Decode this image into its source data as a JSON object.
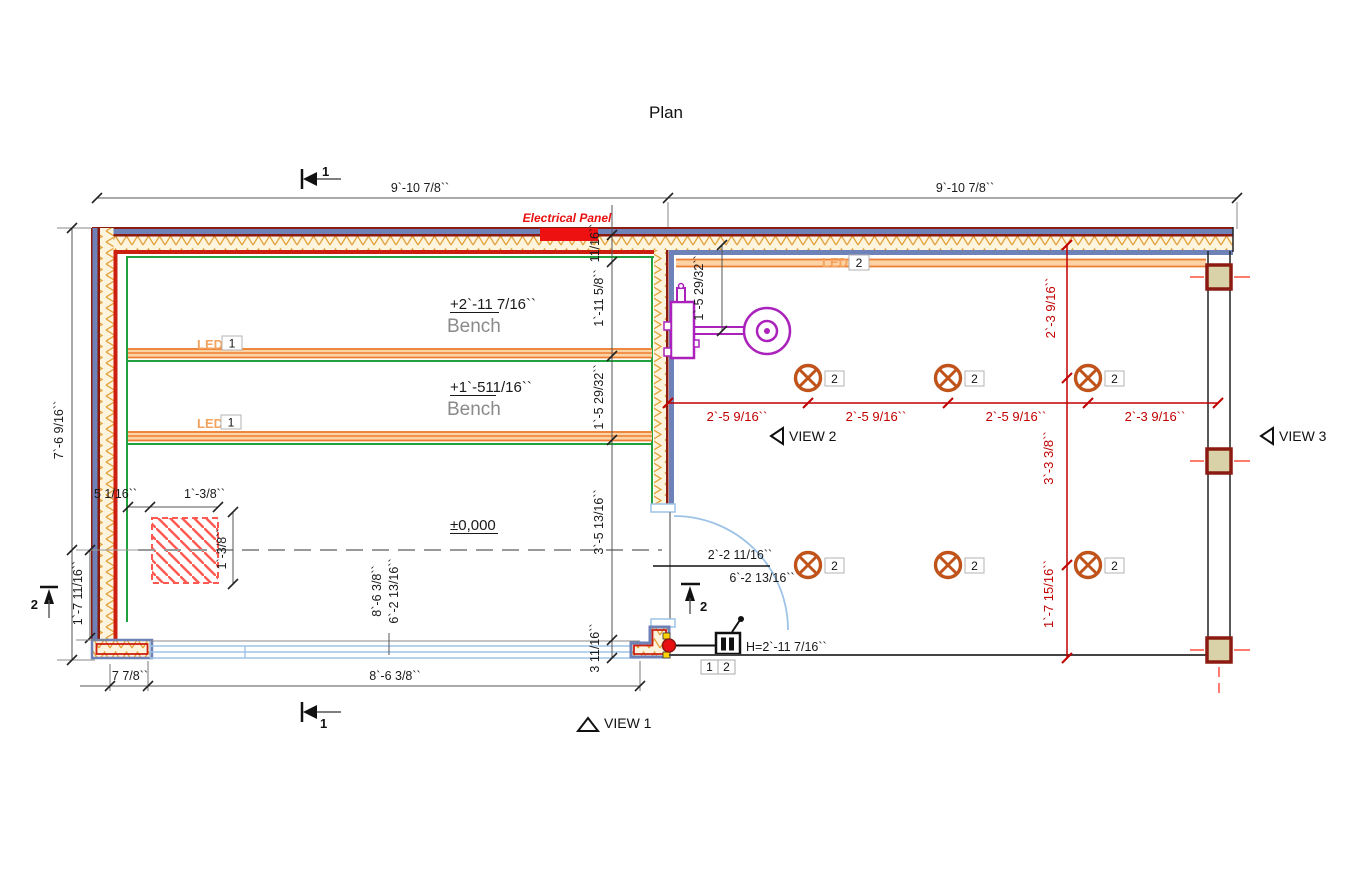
{
  "title": "Plan",
  "labels": {
    "electrical_panel": "Electrical Panel",
    "bench1_level": "+2`-11 7/16``",
    "bench2_level": "+1`-511/16``",
    "bench_name": "Bench",
    "floor_level": "±0,000",
    "led": "LED",
    "led_group_1": "1",
    "led_group_2": "2",
    "light_tag": "2",
    "switch_height": "H=2`-11 7/16``",
    "switch_tag_1": "1",
    "switch_tag_2": "2",
    "door_offset_top": "2`-2 11/16``",
    "door_offset_bottom": "6`-2 13/16``",
    "view_1": "VIEW 1",
    "view_2": "VIEW 2",
    "view_3": "VIEW 3",
    "section_1": "1",
    "section_2": "2"
  },
  "dimensions": {
    "top_left": "9`-10 7/8``",
    "top_right": "9`-10 7/8``",
    "left_height": "7`-6 9/16``",
    "left_lower": "1`-7 11/16``",
    "bottom_wall_foot": "7 7/8``",
    "bottom_width": "8`-6 3/8``",
    "mid_wall": "11/16``",
    "mid_bench1": "1`-11 5/8``",
    "mid_bench2": "1`-5 29/32``",
    "mid_floor": "3`-5 13/16``",
    "mid_bottom": "3 11/16``",
    "fixture_drop": "1`-5 29/32``",
    "square_offset": "5 1/16``",
    "square_width": "1`-3/8``",
    "square_height": "1`-3/8``",
    "lights_spacing": "2`-5 9/16``",
    "lights_end": "2`-3 9/16``",
    "lights_top_v": "2`-3 9/16``",
    "lights_mid_v": "3`-3 3/8``",
    "lights_bottom_v": "1`-7 15/16``",
    "room_width": "8`-6 3/8``",
    "room_depth": "6`-2 13/16``"
  },
  "colors": {
    "wall_blue": "#6e82b8",
    "wall_red": "#cc1f10",
    "wall_dark_red": "#8b1a10",
    "insulation_orange": "#e3a23c",
    "trim_green": "#22a03c",
    "led_orange": "#ed7d31",
    "light_fixture_orange": "#c0531a",
    "dimension_red": "#c00000",
    "fixture_purple": "#aa22bb",
    "glass_blue": "#9dc3e6",
    "panel_red": "#ee1111",
    "hatch_red": "#ff5a52"
  }
}
